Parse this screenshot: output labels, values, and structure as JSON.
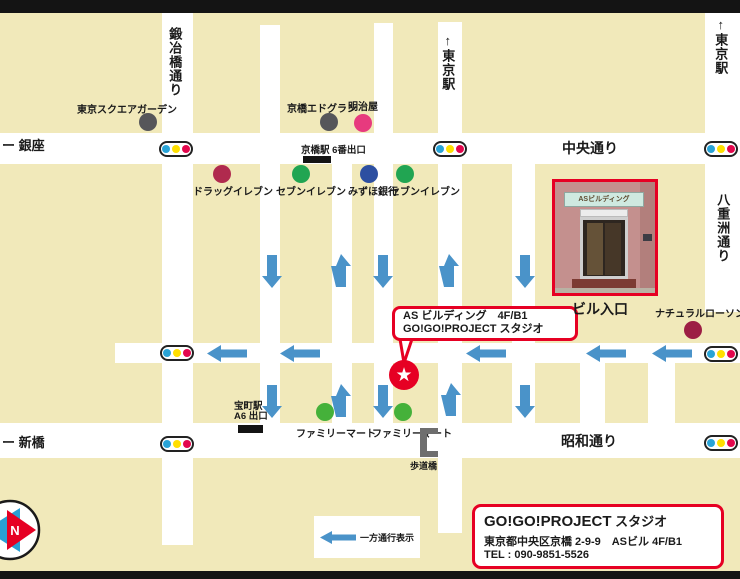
{
  "colors": {
    "background": "#f1e9ba",
    "street": "#ffffff",
    "frame_bar": "#141414",
    "arrow": "#4a93c9",
    "accent_red": "#e60023",
    "tl_blue": "#29a3d6",
    "tl_yellow": "#ffdf00",
    "tl_red": "#e3074d",
    "compass_blue": "#2a9fd4",
    "compass_red": "#e60023",
    "bracket_gray": "#6e6e6e"
  },
  "bars": [
    {
      "x": 0,
      "y": 0,
      "w": 740,
      "h": 13
    },
    {
      "x": 0,
      "y": 571,
      "w": 740,
      "h": 8
    }
  ],
  "streets": [
    {
      "x": 0,
      "y": 133,
      "w": 740,
      "h": 31
    },
    {
      "x": 115,
      "y": 343,
      "w": 625,
      "h": 20
    },
    {
      "x": 0,
      "y": 423,
      "w": 740,
      "h": 35
    },
    {
      "x": 162,
      "y": 13,
      "w": 31,
      "h": 532
    },
    {
      "x": 260,
      "y": 25,
      "w": 20,
      "h": 433
    },
    {
      "x": 332,
      "y": 164,
      "w": 20,
      "h": 294
    },
    {
      "x": 374,
      "y": 23,
      "w": 19,
      "h": 435
    },
    {
      "x": 438,
      "y": 22,
      "w": 24,
      "h": 511
    },
    {
      "x": 512,
      "y": 164,
      "w": 23,
      "h": 294
    },
    {
      "x": 580,
      "y": 363,
      "w": 25,
      "h": 95
    },
    {
      "x": 648,
      "y": 363,
      "w": 27,
      "h": 95
    },
    {
      "x": 705,
      "y": 13,
      "w": 35,
      "h": 299
    }
  ],
  "street_labels": [
    {
      "id": "kajibashi-dori",
      "text": "鍛冶橋通り",
      "x": 167,
      "y": 27,
      "size": 13,
      "vertical": true
    },
    {
      "id": "tokyo-station-mid",
      "text": "↑東京駅",
      "x": 440,
      "y": 33,
      "size": 13,
      "vertical": true
    },
    {
      "id": "tokyo-station-right",
      "text": "↑東京駅",
      "x": 713,
      "y": 17,
      "size": 13,
      "vertical": true
    },
    {
      "id": "ginza",
      "text": "ー 銀座",
      "x": 2,
      "y": 139,
      "size": 13
    },
    {
      "id": "chuo-dori",
      "text": "中央通り",
      "x": 562,
      "y": 141,
      "size": 14
    },
    {
      "id": "yaesu-dori",
      "text": "八重洲通り",
      "x": 715,
      "y": 193,
      "size": 13,
      "vertical": true
    },
    {
      "id": "shimbashi",
      "text": "ー 新橋",
      "x": 2,
      "y": 436,
      "size": 13
    },
    {
      "id": "showa-dori",
      "text": "昭和通り",
      "x": 561,
      "y": 434,
      "size": 14
    }
  ],
  "traffic_lights": [
    {
      "x": 159,
      "y": 141
    },
    {
      "x": 433,
      "y": 141
    },
    {
      "x": 704,
      "y": 141
    },
    {
      "x": 160,
      "y": 345
    },
    {
      "x": 704,
      "y": 346
    },
    {
      "x": 160,
      "y": 436
    },
    {
      "x": 704,
      "y": 435
    }
  ],
  "pois": [
    {
      "id": "tokyo-square-garden",
      "label": "東京スクエアガーデン",
      "color": "#56565a",
      "dot": {
        "x": 148,
        "y": 122
      },
      "label_pos": {
        "x": 77,
        "y": 101
      }
    },
    {
      "id": "kyobashi-edogrand",
      "label": "京橋エドグラン",
      "color": "#56565a",
      "dot": {
        "x": 329,
        "y": 122
      },
      "label_pos": {
        "x": 287,
        "y": 100
      }
    },
    {
      "id": "meijiya",
      "label": "明治屋",
      "color": "#e73a7e",
      "dot": {
        "x": 363,
        "y": 123
      },
      "label_pos": {
        "x": 348,
        "y": 98
      }
    },
    {
      "id": "drug-eleven",
      "label": "ドラッグイレブン",
      "color": "#b02a4e",
      "dot": {
        "x": 222,
        "y": 174
      },
      "label_pos": {
        "x": 193,
        "y": 183
      }
    },
    {
      "id": "seven-eleven-1",
      "label": "セブンイレブン",
      "color": "#21a552",
      "dot": {
        "x": 301,
        "y": 174
      },
      "label_pos": {
        "x": 276,
        "y": 183
      }
    },
    {
      "id": "mizuho-bank",
      "label": "みずほ銀行",
      "color": "#2d4fa1",
      "dot": {
        "x": 369,
        "y": 174
      },
      "label_pos": {
        "x": 348,
        "y": 183
      }
    },
    {
      "id": "seven-eleven-2",
      "label": "セブンイレブン",
      "color": "#21a552",
      "dot": {
        "x": 405,
        "y": 174
      },
      "label_pos": {
        "x": 390,
        "y": 183
      }
    },
    {
      "id": "natural-lawson",
      "label": "ナチュラルローソン",
      "color": "#9c1e44",
      "dot": {
        "x": 693,
        "y": 330
      },
      "label_pos": {
        "x": 655,
        "y": 305
      }
    },
    {
      "id": "family-mart-1",
      "label": "ファミリーマート",
      "color": "#45b13a",
      "dot": {
        "x": 325,
        "y": 412
      },
      "label_pos": {
        "x": 296,
        "y": 425
      }
    },
    {
      "id": "family-mart-2",
      "label": "ファミリーマート",
      "color": "#45b13a",
      "dot": {
        "x": 403,
        "y": 412
      },
      "label_pos": {
        "x": 372,
        "y": 425
      }
    }
  ],
  "exits": [
    {
      "id": "kyobashi-exit-6",
      "lines": [
        "京橋駅 6番出口"
      ],
      "x": 301,
      "y": 146,
      "rect": {
        "x": 303,
        "y": 156,
        "w": 28,
        "h": 7
      }
    },
    {
      "id": "takaracho-exit-a6",
      "lines": [
        "宝町駅",
        "A6 出口"
      ],
      "x": 234,
      "y": 402,
      "rect": {
        "x": 238,
        "y": 425,
        "w": 25,
        "h": 8
      }
    }
  ],
  "arrows": [
    {
      "dir": "down",
      "x": 262,
      "y": 255
    },
    {
      "dir": "up",
      "x": 331,
      "y": 254
    },
    {
      "dir": "down",
      "x": 373,
      "y": 255
    },
    {
      "dir": "up",
      "x": 439,
      "y": 254
    },
    {
      "dir": "down",
      "x": 515,
      "y": 255
    },
    {
      "dir": "down",
      "x": 262,
      "y": 385
    },
    {
      "dir": "up",
      "x": 331,
      "y": 384
    },
    {
      "dir": "down",
      "x": 373,
      "y": 385
    },
    {
      "dir": "up",
      "x": 441,
      "y": 383
    },
    {
      "dir": "down",
      "x": 515,
      "y": 385
    },
    {
      "dir": "left",
      "x": 207,
      "y": 345
    },
    {
      "dir": "left",
      "x": 280,
      "y": 345
    },
    {
      "dir": "left",
      "x": 466,
      "y": 345
    },
    {
      "dir": "left",
      "x": 586,
      "y": 345
    },
    {
      "dir": "left",
      "x": 652,
      "y": 345
    }
  ],
  "bubble": {
    "line1": "AS ビルディング　4F/B1",
    "line2": "GO!GO!PROJECT スタジオ"
  },
  "star": {
    "glyph": "★"
  },
  "photo": {
    "sign": "ASビルディング",
    "caption": "ビル入口"
  },
  "info_box": {
    "title_bold": "GO!GO!PROJECT",
    "title_suffix": " スタジオ",
    "address": "東京都中央区京橋 2-9-9　ASビル 4F/B1",
    "tel": "TEL : 090-9851-5526"
  },
  "legend": {
    "label": "一方通行表示"
  },
  "compass": {
    "label": "N"
  },
  "bridge": {
    "label": "歩道橋"
  }
}
